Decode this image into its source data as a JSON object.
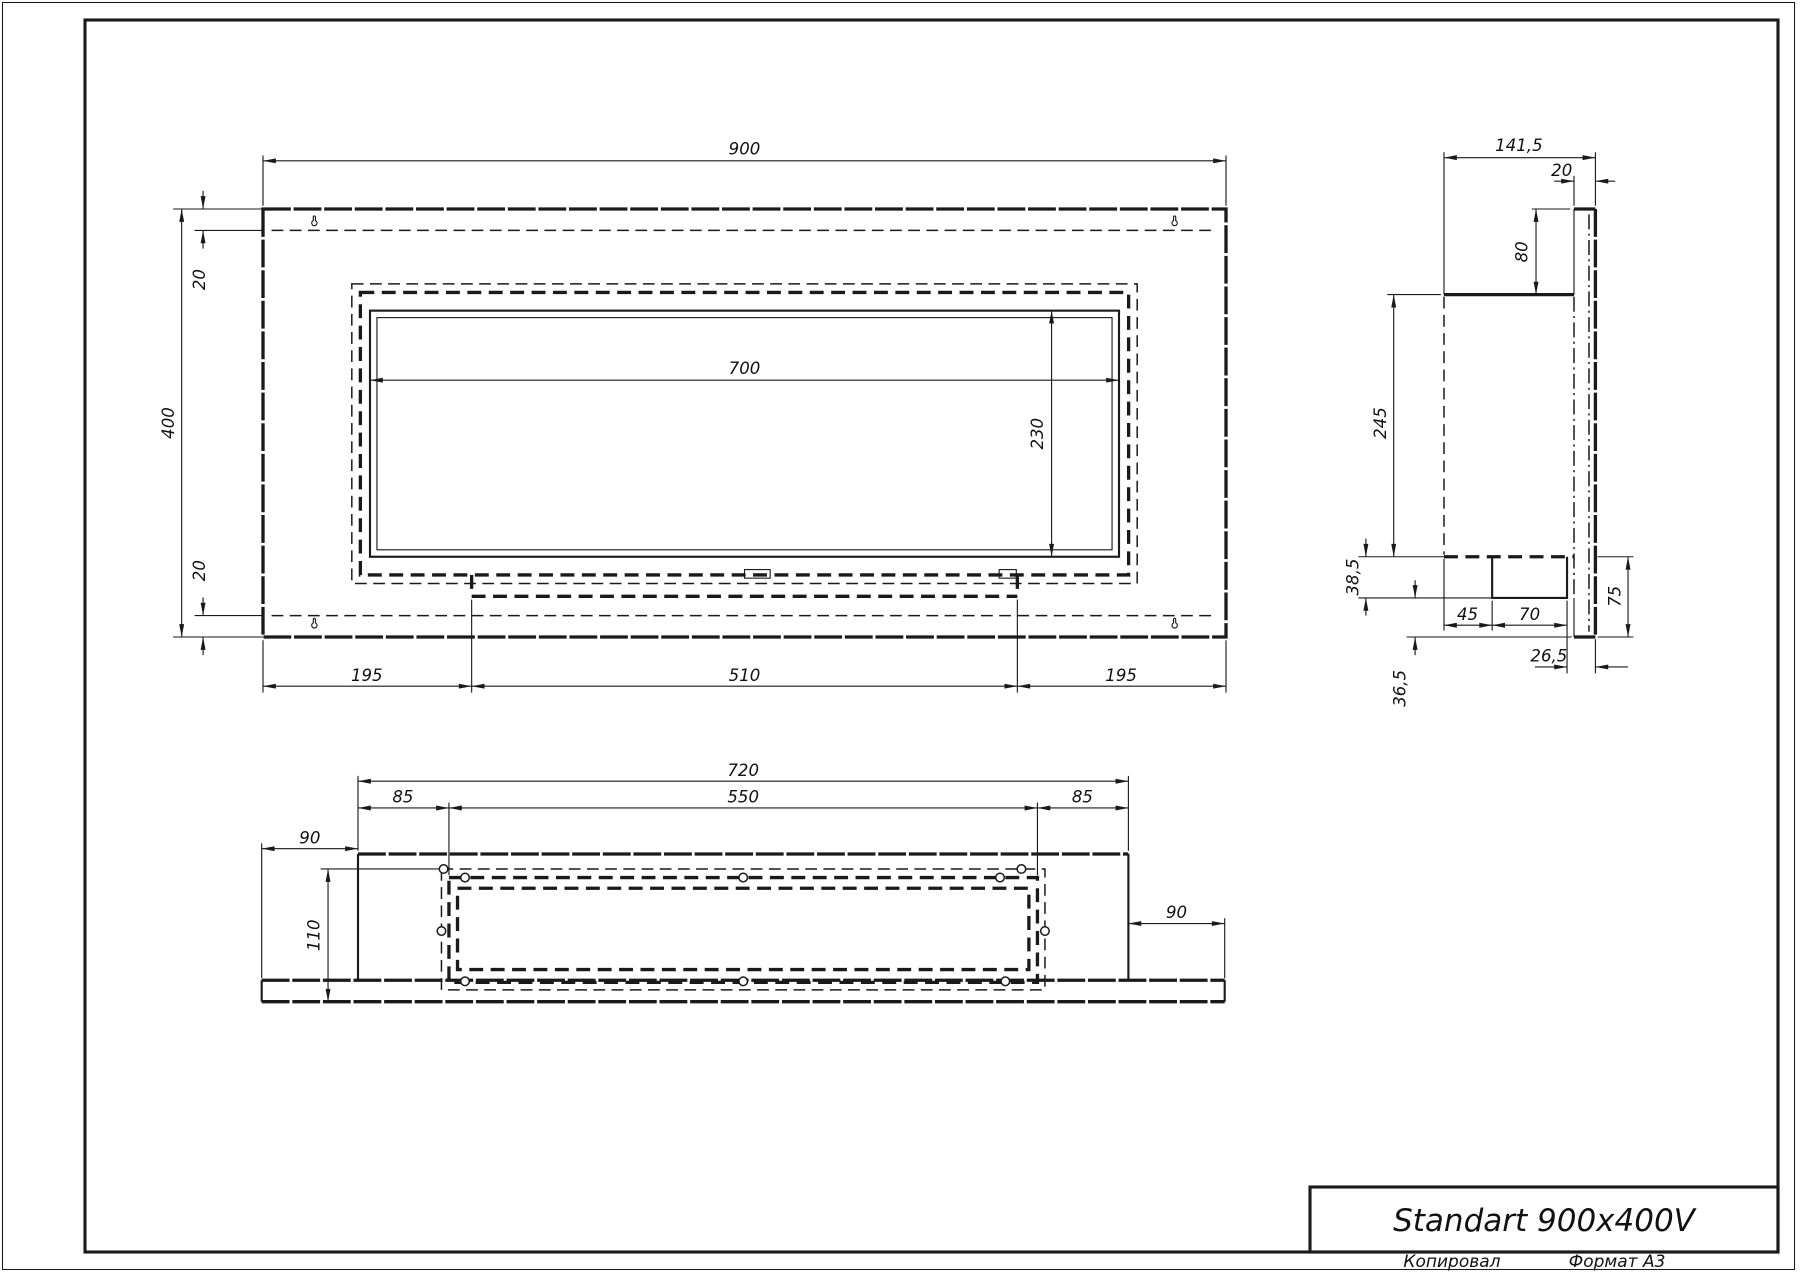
{
  "sheet": {
    "copied_label": "Копировал",
    "format_label": "Формат А3"
  },
  "title_block": {
    "title": "Standart 900x400V"
  },
  "views": {
    "front": {
      "dims": {
        "width": "900",
        "height": "400",
        "top_inset": "20",
        "bottom_inset": "20",
        "opening_width": "700",
        "opening_height": "230",
        "left_offset": "195",
        "tray_width": "510",
        "right_offset": "195"
      }
    },
    "side": {
      "dims": {
        "depth": "141,5",
        "plate_thickness": "20",
        "flange_height": "80",
        "body_height": "245",
        "tray_height": "38,5",
        "front_to_tray": "45",
        "tray_width": "70",
        "back_height": "75",
        "tray_to_back": "26,5",
        "below_tray": "36,5"
      }
    },
    "bottom": {
      "dims": {
        "body_width": "720",
        "left_inset": "85",
        "opening_width": "550",
        "right_inset": "85",
        "left_overhang": "90",
        "right_overhang": "90",
        "depth": "110"
      }
    }
  }
}
